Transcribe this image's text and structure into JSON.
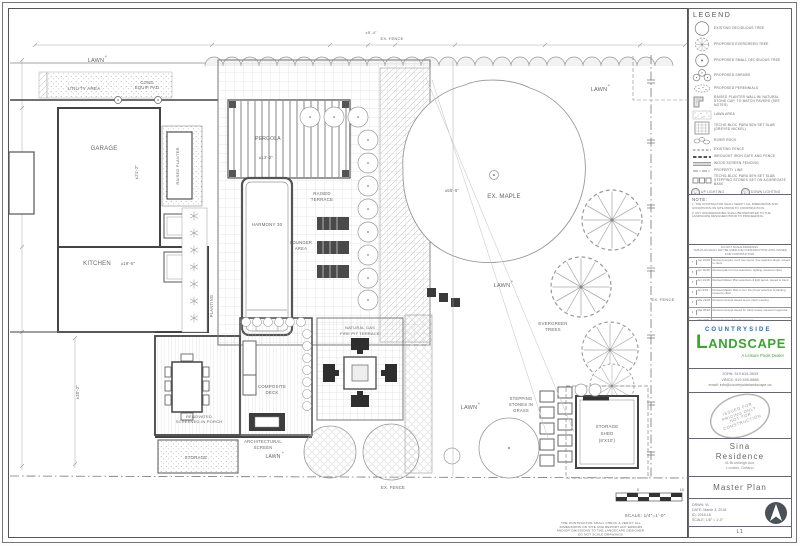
{
  "plan": {
    "labels": [
      {
        "t": "LAWN",
        "x": 96,
        "y": 62,
        "s": 5.5
      },
      {
        "t": "+",
        "x": 106,
        "y": 58,
        "s": 4.5
      },
      {
        "t": "UTILITY AREA",
        "x": 84,
        "y": 90,
        "s": 4.6
      },
      {
        "t": "COND",
        "x": 147,
        "y": 84,
        "s": 4.2
      },
      {
        "t": "EQUIP PAD",
        "x": 147,
        "y": 89,
        "s": 4.2
      },
      {
        "t": "GARAGE",
        "x": 104,
        "y": 150,
        "s": 6
      },
      {
        "t": "±21'-2\"",
        "x": 138,
        "y": 172,
        "s": 4.2,
        "r": -90
      },
      {
        "t": "KITCHEN",
        "x": 97,
        "y": 265,
        "s": 6
      },
      {
        "t": "±19'-5\"",
        "x": 128,
        "y": 265,
        "s": 4.2
      },
      {
        "t": "RAISED PLANTER",
        "x": 179,
        "y": 166,
        "s": 4,
        "r": -90
      },
      {
        "t": "PLANTING",
        "x": 213,
        "y": 306,
        "s": 4.2,
        "r": -90
      },
      {
        "t": "PERGOLA",
        "x": 268,
        "y": 140,
        "s": 5
      },
      {
        "t": "±13'-2\"",
        "x": 266,
        "y": 159,
        "s": 4.2
      },
      {
        "t": "HARMONY 30",
        "x": 267,
        "y": 226,
        "s": 4.4
      },
      {
        "t": "RAISED",
        "x": 322,
        "y": 195,
        "s": 4.4
      },
      {
        "t": "TERRACE",
        "x": 322,
        "y": 201,
        "s": 4.4
      },
      {
        "t": "LOUNGER",
        "x": 301,
        "y": 244,
        "s": 4.2
      },
      {
        "t": "AREA",
        "x": 301,
        "y": 250,
        "s": 4.2
      },
      {
        "t": "EX. MAPLE",
        "x": 504,
        "y": 198,
        "s": 6
      },
      {
        "t": "±55'-5\"",
        "x": 452,
        "y": 192,
        "s": 4.2
      },
      {
        "t": "LAWN",
        "x": 599,
        "y": 91,
        "s": 5.5
      },
      {
        "t": "+",
        "x": 609,
        "y": 87,
        "s": 4.5
      },
      {
        "t": "LAWN",
        "x": 502,
        "y": 287,
        "s": 5.5
      },
      {
        "t": "+",
        "x": 512,
        "y": 283,
        "s": 4.5
      },
      {
        "t": "EVERGREEN",
        "x": 553,
        "y": 325,
        "s": 4.4
      },
      {
        "t": "TREES",
        "x": 553,
        "y": 331,
        "s": 4.4
      },
      {
        "t": "EX. FENCE",
        "x": 663,
        "y": 301,
        "s": 4
      },
      {
        "t": "LAWN",
        "x": 469,
        "y": 409,
        "s": 5.5
      },
      {
        "t": "+",
        "x": 479,
        "y": 405,
        "s": 4.5
      },
      {
        "t": "NATURAL GAS",
        "x": 360,
        "y": 329,
        "s": 4
      },
      {
        "t": "FIRE PIT TERRACE",
        "x": 360,
        "y": 335,
        "s": 4
      },
      {
        "t": "COMPOSITE",
        "x": 272,
        "y": 388,
        "s": 4.4
      },
      {
        "t": "DECK",
        "x": 272,
        "y": 394,
        "s": 4.4
      },
      {
        "t": "RENOVATED",
        "x": 199,
        "y": 418,
        "s": 4
      },
      {
        "t": "SCREENED-IN PORCH",
        "x": 199,
        "y": 423,
        "s": 4
      },
      {
        "t": "ARCHITECTURAL",
        "x": 263,
        "y": 443,
        "s": 4.2
      },
      {
        "t": "SCREEN",
        "x": 263,
        "y": 449,
        "s": 4.2
      },
      {
        "t": "LAWN",
        "x": 273,
        "y": 458,
        "s": 5
      },
      {
        "t": "+",
        "x": 283,
        "y": 454,
        "s": 4
      },
      {
        "t": "STORAGE",
        "x": 196,
        "y": 459,
        "s": 4.4
      },
      {
        "t": "STEPPING",
        "x": 521,
        "y": 400,
        "s": 4.2
      },
      {
        "t": "STONES IN",
        "x": 521,
        "y": 406,
        "s": 4.2
      },
      {
        "t": "GRASS",
        "x": 521,
        "y": 412,
        "s": 4.2
      },
      {
        "t": "STORAGE",
        "x": 607,
        "y": 428,
        "s": 4.4
      },
      {
        "t": "SHED",
        "x": 607,
        "y": 435,
        "s": 4.4
      },
      {
        "t": "(8'X10')",
        "x": 607,
        "y": 442,
        "s": 4.4
      },
      {
        "t": "EX. FENCE",
        "x": 393,
        "y": 489,
        "s": 4.2
      },
      {
        "t": "±5'-4\"",
        "x": 371,
        "y": 34,
        "s": 4
      },
      {
        "t": "EX. FENCE",
        "x": 392,
        "y": 40,
        "s": 4
      },
      {
        "t": "±30'-2\"",
        "x": 79,
        "y": 392,
        "s": 4.2,
        "r": -90
      },
      {
        "t": "5",
        "x": 638,
        "y": 491,
        "s": 3.8
      },
      {
        "t": "10",
        "x": 682,
        "y": 491,
        "s": 3.8
      },
      {
        "t": "SCALE: 1/4\"=1'-0\"",
        "x": 645,
        "y": 517,
        "s": 4.6
      }
    ],
    "disclaimer_lines": [
      "THE CONTRACTOR SHALL CHECK & VERIFY ALL",
      "DIMENSIONS ON SITE AND REPORT ANY ERRORS",
      "AND/OR OMISSIONS TO THE LANDSCAPE DESIGNER.",
      "DO NOT SCALE DRAWINGS."
    ]
  },
  "legend": {
    "title": "LEGEND",
    "items": [
      {
        "icon": "tree-deciduous-existing",
        "label": "EXISTING DECIDUOUS TREE"
      },
      {
        "icon": "tree-evergreen",
        "label": "PROPOSED EVERGREEN TREE"
      },
      {
        "icon": "tree-small-deciduous",
        "label": "PROPOSED SMALL DECIDUOUS TREE"
      },
      {
        "icon": "shrubs",
        "label": "PROPOSED SHRUBS"
      },
      {
        "icon": "perennials",
        "label": "PROPOSED PERENNIALS"
      },
      {
        "icon": "planter-wall",
        "label": "RAISED PLANTER WALL W/ NATURAL STONE CAP, TO MATCH PAVERS (SEE NOTES)"
      },
      {
        "icon": "stipple",
        "label": "LAWN AREA"
      },
      {
        "icon": "paver-grid",
        "label": "TECHO-BLOC PARA 50% SET SLAB (GREYED NICKEL)"
      },
      {
        "icon": "river-rock",
        "label": "RIVER ROCK"
      },
      {
        "icon": "line-dashed",
        "label": "EXISTING FENCE"
      },
      {
        "icon": "line-heavy-dash",
        "label": "WROUGHT IRON GATE AND FENCE"
      },
      {
        "icon": "line-double",
        "label": "WOOD SCREEN FENCING"
      },
      {
        "icon": "line-dashdot",
        "label": "PROPERTY LINE"
      },
      {
        "icon": "stepper-squares",
        "label": "TECHO-BLOC PARA 50% SET SLAB STEPPING STONES SET ON AGGREGATE BASE"
      }
    ],
    "lighting": [
      {
        "sym": "U",
        "label": "UP LIGHTING"
      },
      {
        "sym": "D",
        "label": "DOWN LIGHTING"
      },
      {
        "sym": "S",
        "label": "STEP LIGHTING"
      },
      {
        "sym": "P",
        "label": "PATH LIGHTING"
      },
      {
        "sym": "W",
        "label": "WALL LIGHTING"
      },
      {
        "sym": "P",
        "label": "POST LIGHTING"
      }
    ]
  },
  "notes": {
    "title": "NOTE:",
    "lines": [
      "1. THE CONTRACTOR SHALL VERIFY ALL DIMENSIONS AND CONDITIONS ON SITE PRIOR TO CONSTRUCTION.",
      "2. ANY DISCREPANCIES SHALL BE REPORTED TO THE LANDSCAPE DESIGNER PRIOR TO PROCEEDING."
    ]
  },
  "revisions": {
    "header_lines": [
      "DO NOT SCALE DRAWINGS.",
      "THIS PLAN SHALL NOT BE USED FOR CONSTRUCTION UNTIL ISSUED FOR CONSTRUCTION."
    ],
    "rows": [
      {
        "no": "7",
        "date": "Jun 20/18",
        "desc": "Revised pergola, rev'd tree layout, tree selection larger, issued to client"
      },
      {
        "no": "6",
        "date": "Apr 16/18",
        "desc": "Revised plan for tree selections, lighting, issued to client"
      },
      {
        "no": "5",
        "date": "Apr 13/18",
        "desc": "Revised Master Plan selections & light layout, issued to client"
      },
      {
        "no": "4",
        "date": "Apr 9/18",
        "desc": "Revised Master Plan to incl. fire pit per selection & planting, issued to client"
      },
      {
        "no": "3",
        "date": "Mar 21/18",
        "desc": "Revised concept issued as per client meeting"
      },
      {
        "no": "2",
        "date": "Mar 20/18",
        "desc": "Revised concept issued for client review, issued for approval"
      },
      {
        "no": "1",
        "date": "Mar 3/18",
        "desc": "Concepts issued for client review"
      }
    ]
  },
  "titleblock": {
    "brand_top": "COUNTRYSIDE",
    "brand_main": "LANDSCAPE",
    "tagline": "A Leisure Pools Dealer",
    "brand_colors": {
      "blue": "#2a6db5",
      "green": "#3aa52f"
    },
    "contact": [
      "JOHN: 519 619-3633",
      "VINCE: 519 495-5888",
      "email: info@countrysidelandscape.ca"
    ],
    "stamp_lines": [
      "ISSUED FOR",
      "PRICING ONLY",
      "NOT FOR",
      "CONSTRUCTION"
    ],
    "client_line1": "Sina",
    "client_line2": "Residence",
    "address": [
      "41 Bromleigh Ave,",
      "London, Ontario"
    ],
    "sheet_title": "Master Plan",
    "info": [
      "DRWN: VL",
      "DATE: March 3, 2018",
      "ID: 2018-18",
      "SCALE: 1/8\" = 1'-0\""
    ],
    "sheet_no": "L1"
  }
}
